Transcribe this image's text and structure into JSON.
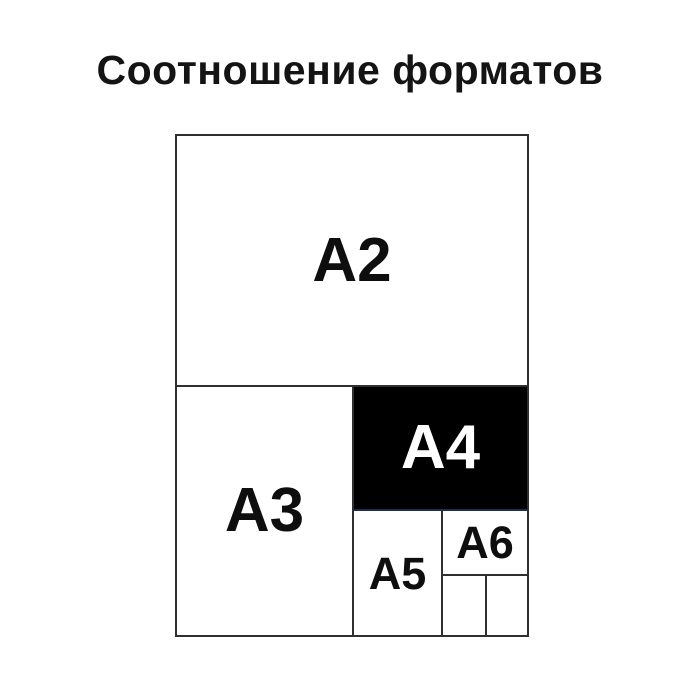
{
  "title": "Соотношение форматов",
  "figure": {
    "a2": {
      "label": "A2"
    },
    "a3": {
      "label": "A3"
    },
    "a4": {
      "label": "A4"
    },
    "a5": {
      "label": "A5"
    },
    "a6": {
      "label": "A6"
    },
    "colors": {
      "background": "#ffffff",
      "line": "#2f2f2f",
      "label_text": "#0e0e0e",
      "a4_fill": "#000000",
      "a4_text": "#ffffff",
      "a4_bottom_edge": "#1e2d4e"
    }
  }
}
